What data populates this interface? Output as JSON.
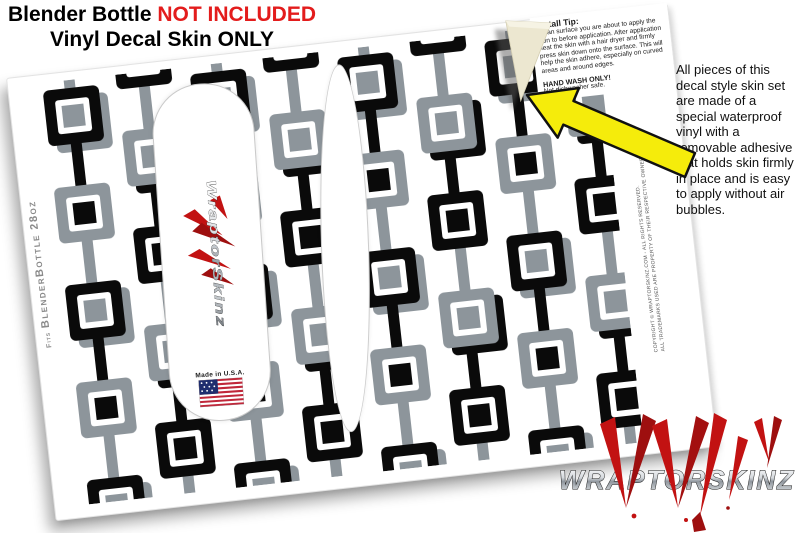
{
  "header": {
    "title_prefix": "Blender Bottle ",
    "title_highlight": "NOT INCLUDED",
    "subtitle": "Vinyl Decal Skin ONLY"
  },
  "install_tip": {
    "title": "Install Tip:",
    "body": "Clean surface you are about to apply the skin to before application. After application heat the skin with a hair dryer and firmly press skin down onto the surface. This will help the skin adhere, especially on curved areas and around edges.",
    "warning": "HAND WASH ONLY!",
    "warning_note": "Not dishwasher safe."
  },
  "side_note": {
    "text": "All pieces of this decal style  skin set are made of a special waterproof vinyl with a removable adhesive that holds skin firmly in place and is easy to apply without air bubbles."
  },
  "sheet": {
    "fits_prefix": "Fits",
    "fits_label": "BlenderBottle 28oz",
    "copyright_line1": "COPYRIGHT © WRAPTORSKINZ.COM - ALL RIGHTS RESERVED.",
    "copyright_line2": "ALL TRADEMARKS USED ARE PROPERTY OF THEIR RESPECTIVE OWNERS.",
    "skin_brand_vertical": "WraptorSkinz",
    "made_in": "Made in U.S.A."
  },
  "brand": {
    "logo_text": "WRAPTORSKINZ"
  },
  "colors": {
    "accent_red": "#e31c1c",
    "arrow_yellow": "#f5ec0b",
    "pattern_black": "#0a0a0a",
    "pattern_gray": "#8d959b",
    "claw_red": "#c21212",
    "liner_cream": "#ece7d0"
  }
}
